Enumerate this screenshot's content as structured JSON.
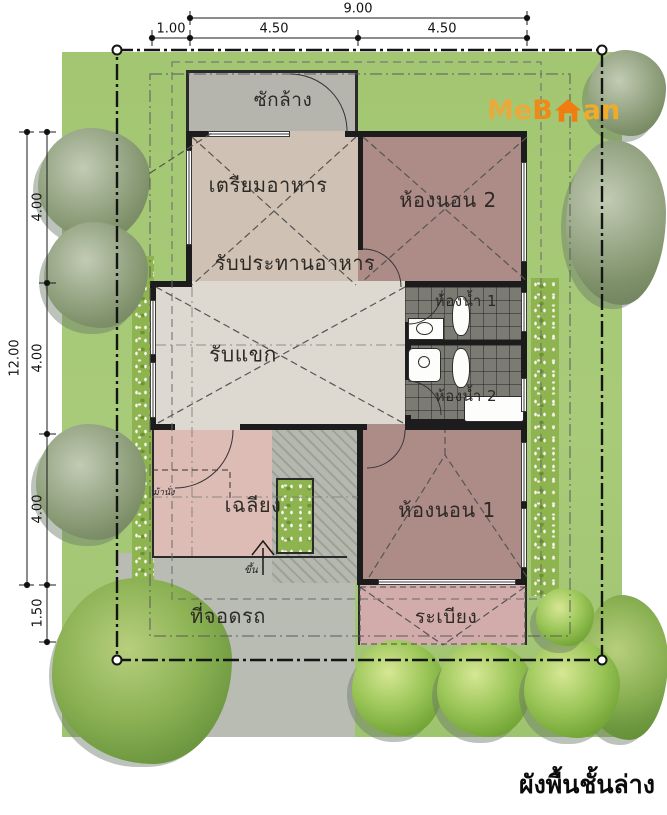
{
  "title": "ผังพื้นชั้นล่าง",
  "logo": {
    "part1": "Me",
    "part2": "B",
    "part3": "an",
    "icon": "house-icon",
    "color_me": "#e9a93c",
    "color_b": "#ef8a16",
    "color_an": "#f0ab28",
    "color_house": "#ef7d12"
  },
  "dimensions": {
    "top": {
      "overall": "9.00",
      "segments": [
        "1.00",
        "4.50",
        "4.50"
      ]
    },
    "left": {
      "overall": "12.00",
      "segments": [
        "4.00",
        "4.00",
        "4.00",
        "1.50"
      ]
    }
  },
  "rooms": {
    "washing": {
      "label": "ซักล้าง"
    },
    "kitchen": {
      "label": "เตรียมอาหาร"
    },
    "dining": {
      "label": "รับประทานอาหาร"
    },
    "bedroom2": {
      "label": "ห้องนอน 2"
    },
    "bath1": {
      "label": "ห้องน้ำ 1"
    },
    "living": {
      "label": "รับแขก"
    },
    "bath2": {
      "label": "ห้องน้ำ 2"
    },
    "porch": {
      "label": "เฉลียง"
    },
    "bedroom1": {
      "label": "ห้องนอน 1"
    },
    "carport": {
      "label": "ที่จอดรถ"
    },
    "terrace": {
      "label": "ระเบียง"
    }
  },
  "annotations": {
    "bench": "ม้านั่ง",
    "stairs_up": "ขึ้น"
  },
  "colors": {
    "lawn": "#a6c878",
    "driveway": "#b9bcb2",
    "washing": "#b5b5ae",
    "kitchen_dining": "#cfc1b3",
    "living_floor": "#ddd9d1",
    "bedroom": "#ad8b87",
    "bathroom_tile": "#77776f",
    "porch": "#dcbcb4",
    "terrace": "#d2abab",
    "wall": "#1c1c1c"
  }
}
